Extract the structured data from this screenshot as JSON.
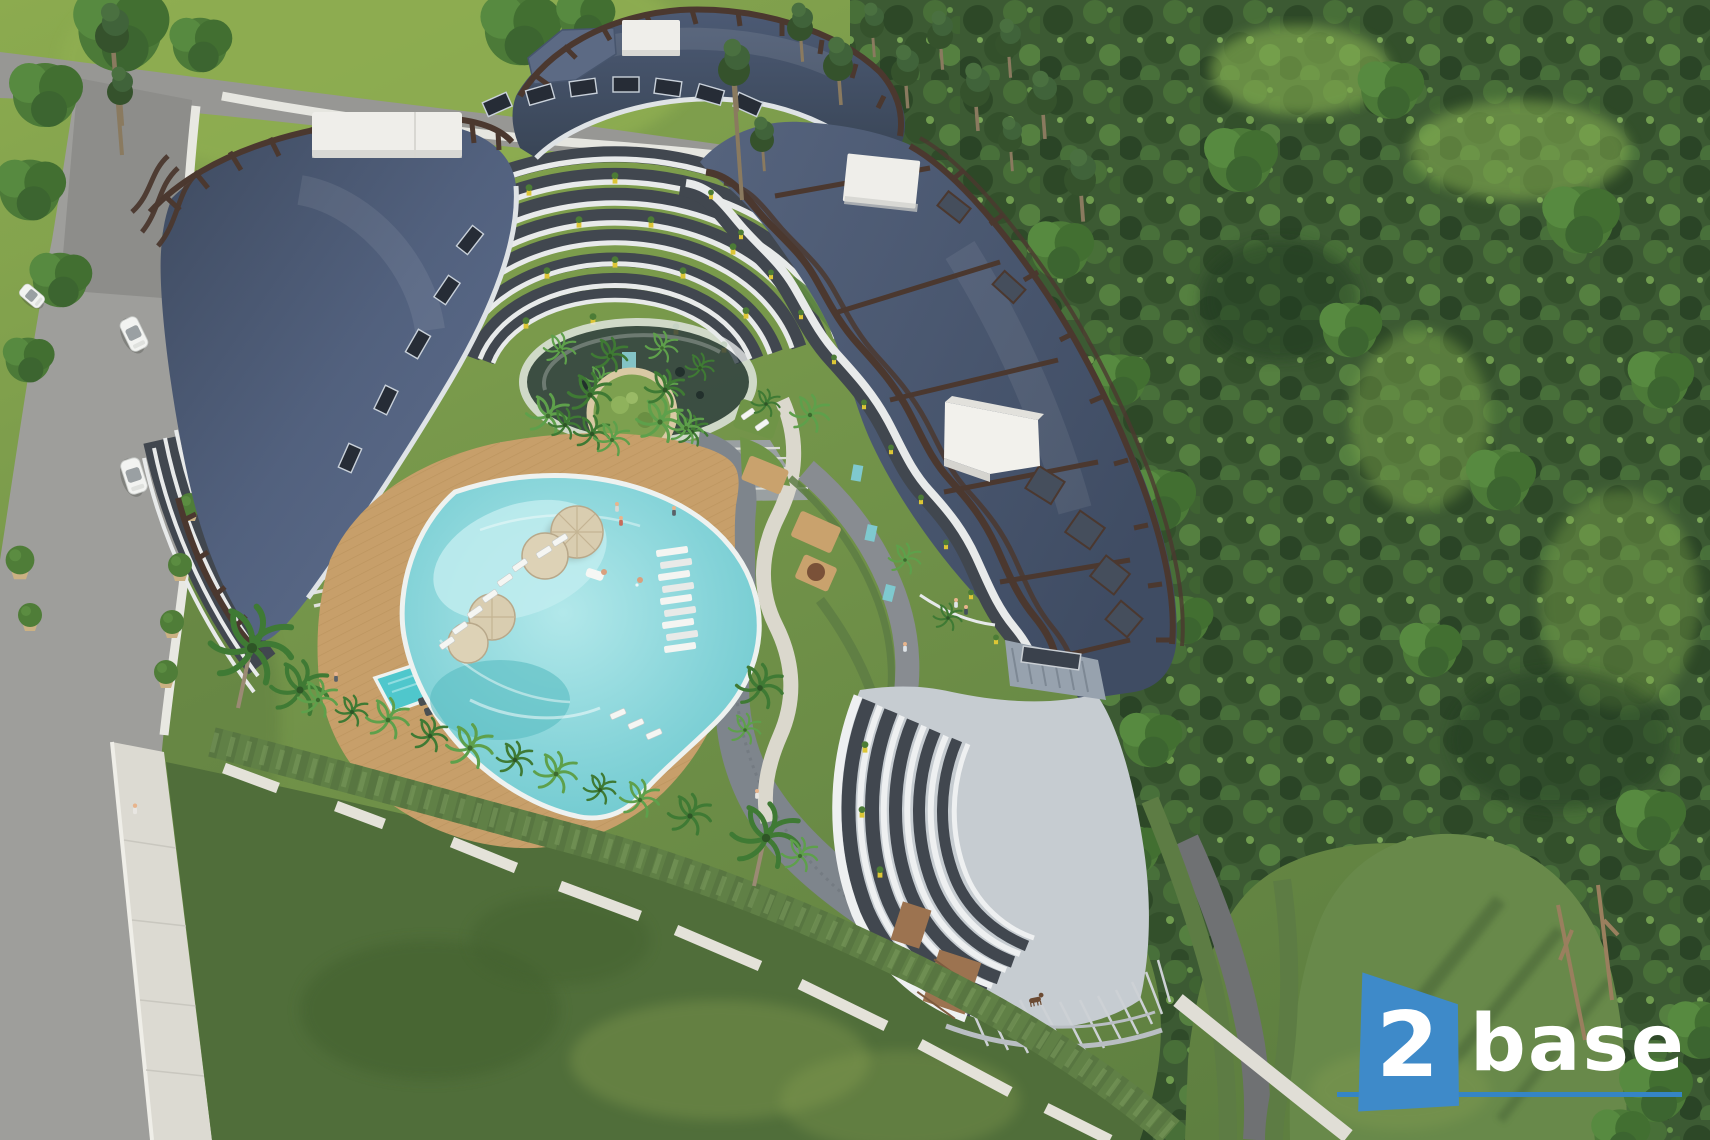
{
  "meta": {
    "description": "Aerial 3D architectural rendering of a curved luxury apartment complex with a lagoon swimming pool, landscaped courtyard, perimeter road with cars, lawns and a dense pine forest",
    "image_type": "3d-render-aerial"
  },
  "logo": {
    "number": "2",
    "word": "base",
    "badge_color": "#3e8ac9",
    "underline_color": "#3585c5",
    "text_color": "#ffffff"
  },
  "palette": {
    "grass_bright": "#8cab4f",
    "grass_mid": "#6e8f45",
    "lawn_dark": "#506e3a",
    "lawn_logo_area": "#68894a",
    "forest_base": "#3c5a33",
    "road_grey": "#9b9b98",
    "sidewalk_white": "#e6e6e0",
    "wall_white": "#dcdad2",
    "hedge_green": "#608046",
    "roof_slate": "#4e5c76",
    "trellis_brown": "#4b382f",
    "fascia_white": "#dfe3e6",
    "facade_white": "#e8eaea",
    "planter_yellow": "#ddc636",
    "deck_tan": "#c79f6a",
    "pool_water": "#7fd0d6",
    "umbrella_beige": "#d9cdb0",
    "cube_white": "#efeeea",
    "car_white": "#f2f3f1"
  },
  "scene": {
    "buildings": {
      "wings": 3,
      "rooftop_units": 4,
      "balcony_planters": "yellow"
    },
    "pool_area": {
      "main_pool": 1,
      "kids_pool": 1,
      "umbrellas": 4
    },
    "environment": {
      "forest_side": "right",
      "road_side": "left",
      "cars_visible": 3
    }
  }
}
